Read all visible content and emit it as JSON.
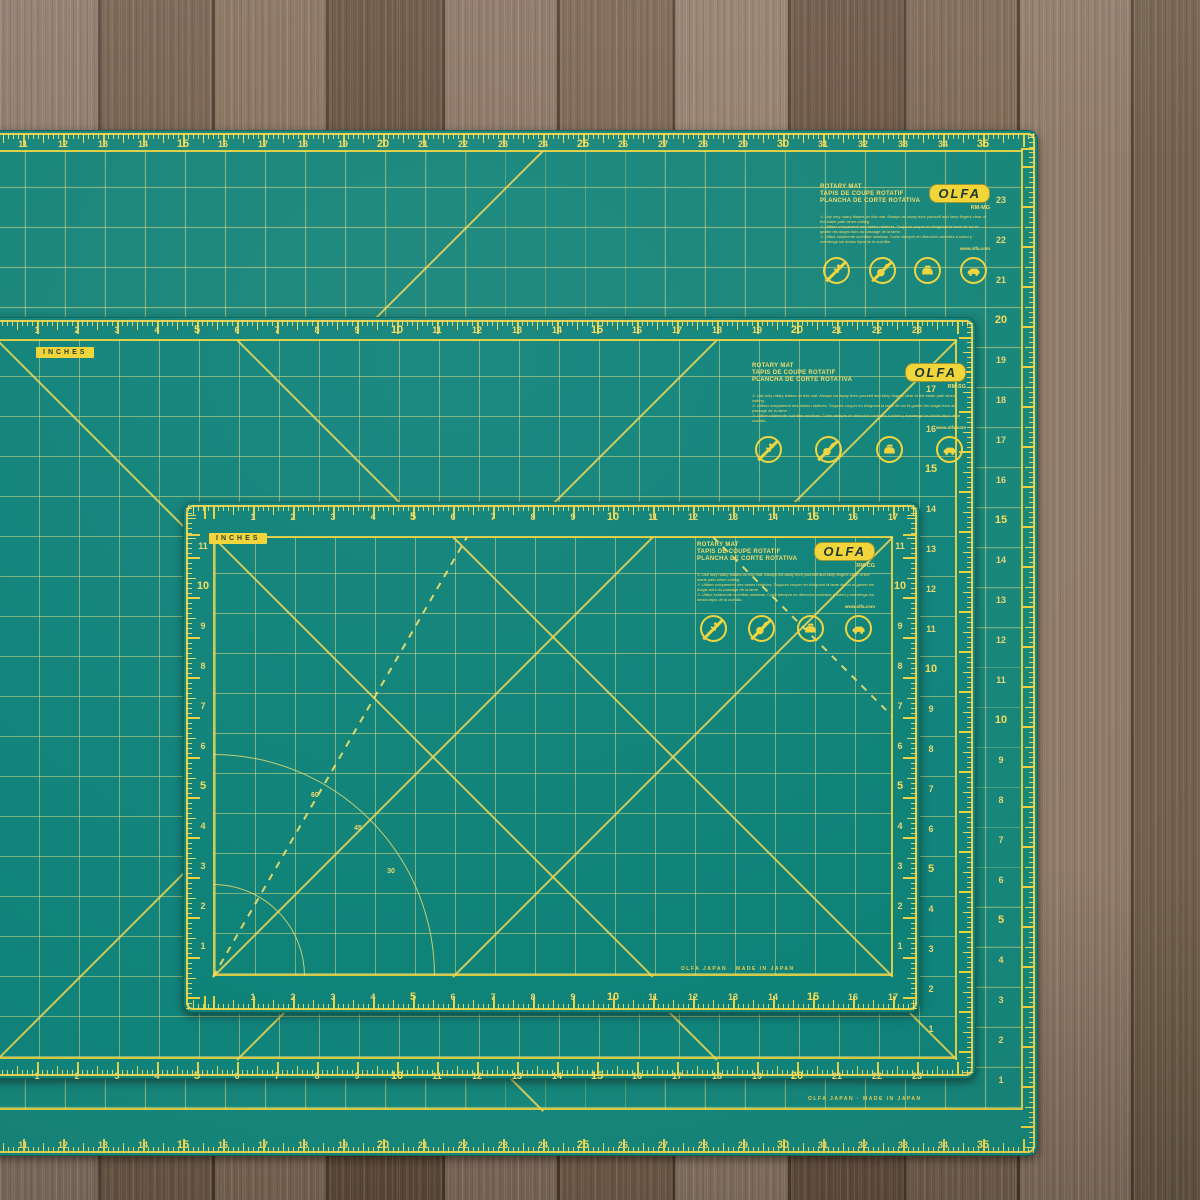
{
  "scene": {
    "description": "Three green OLFA self-healing rotary cutting mats stacked on a rustic wooden table"
  },
  "colors": {
    "mat_green": "#11837A",
    "mat_green_large": "#16857A",
    "grid_line": "#D9D489",
    "bright_yellow": "#F0D43C",
    "number_yellow": "#EDDA6E",
    "label_plate": "#F2D435",
    "wood_dark": "#6A5544",
    "wood_light": "#96826F"
  },
  "inches_tag": "INCHES",
  "brand": "OLFA",
  "label_block": {
    "title_lines": [
      "ROTARY MAT",
      "TAPIS DE COUPE ROTATIF",
      "PLANCHA DE CORTE ROTATIVA"
    ],
    "warnings": [
      "⚠ Use only rotary blades on this mat. Always cut away from yourself and keep fingers clear of the blade path when cutting.",
      "⚠ Utiliser uniquement des lames rotatives. Toujours couper en éloignant la lame de soi et garder les doigts hors du passage de la lame.",
      "⚠ Utilice solamente cuchillas rotativas. Corte siempre en dirección contraria a usted y mantenga los dedos lejos de la cuchilla."
    ],
    "website": "www.olfa.com",
    "icons": [
      "no-pins-icon",
      "no-rotary-tool-icon",
      "no-iron-icon",
      "no-hot-car-icon"
    ],
    "footer": "OLFA JAPAN · MADE IN JAPAN"
  },
  "mats": [
    {
      "id": "large",
      "name": "24 x 36 inch cutting mat",
      "model": "RM-MG",
      "h_numbers": {
        "from": 1,
        "to": 35,
        "bold_every": 5
      },
      "v_numbers": {
        "from": 1,
        "to": 23,
        "bold_every": 5
      },
      "has_inches_tag": false,
      "has_footer": true,
      "has_arcs": false
    },
    {
      "id": "middle",
      "name": "18 x 24 inch cutting mat",
      "model": "RM-SG",
      "h_numbers": {
        "from": 1,
        "to": 23,
        "bold_every": 5
      },
      "v_numbers": {
        "from": 1,
        "to": 17,
        "bold_every": 5
      },
      "has_inches_tag": true,
      "has_footer": false,
      "has_arcs": false
    },
    {
      "id": "small",
      "name": "12 x 18 inch cutting mat",
      "model": "RM-CG",
      "h_numbers": {
        "from": 1,
        "to": 17,
        "bold_every": 5
      },
      "v_numbers": {
        "from": 1,
        "to": 11,
        "bold_every": 5
      },
      "has_inches_tag": true,
      "has_footer": true,
      "has_arcs": true,
      "angle_labels": [
        "60",
        "45",
        "30"
      ]
    }
  ]
}
